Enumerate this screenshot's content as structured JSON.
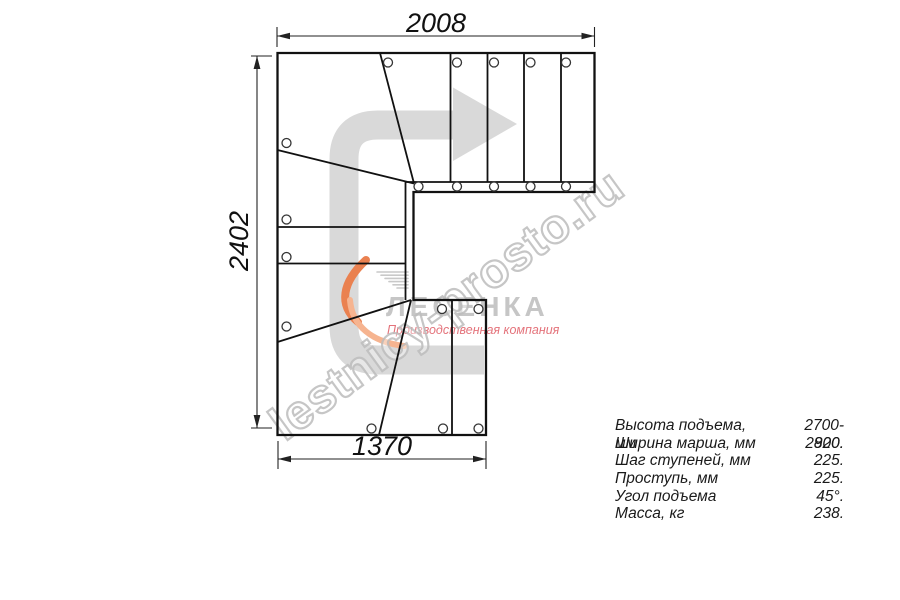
{
  "drawing": {
    "dim_top": "2008",
    "dim_left": "2402",
    "dim_bottom": "1370"
  },
  "watermark": {
    "text": "lestnicy-prosto.ru",
    "color": "#bdbdbd"
  },
  "logo": {
    "wordmark": "ЛЕСЕНКА",
    "tagline": "Производственная компания",
    "wordmark_color": "#c6c6c6",
    "tagline_color": "#e4737b",
    "swoosh_orange": "#ea8150",
    "swoosh_salmon": "#f6b490",
    "speedline_gray": "#c9c9c9"
  },
  "direction_arrow": {
    "color": "#d9d9d9"
  },
  "line_color": "#111111",
  "specs": {
    "rows": [
      {
        "label": "Высота подъема, мм",
        "value": "2700-2820."
      },
      {
        "label": "Ширина марша, мм",
        "value": "900."
      },
      {
        "label": "Шаг ступеней, мм",
        "value": "225."
      },
      {
        "label": "Проступь, мм",
        "value": "225."
      },
      {
        "label": "Угол подъема",
        "value": "45°."
      },
      {
        "label": "Масса, кг",
        "value": "238."
      }
    ]
  }
}
